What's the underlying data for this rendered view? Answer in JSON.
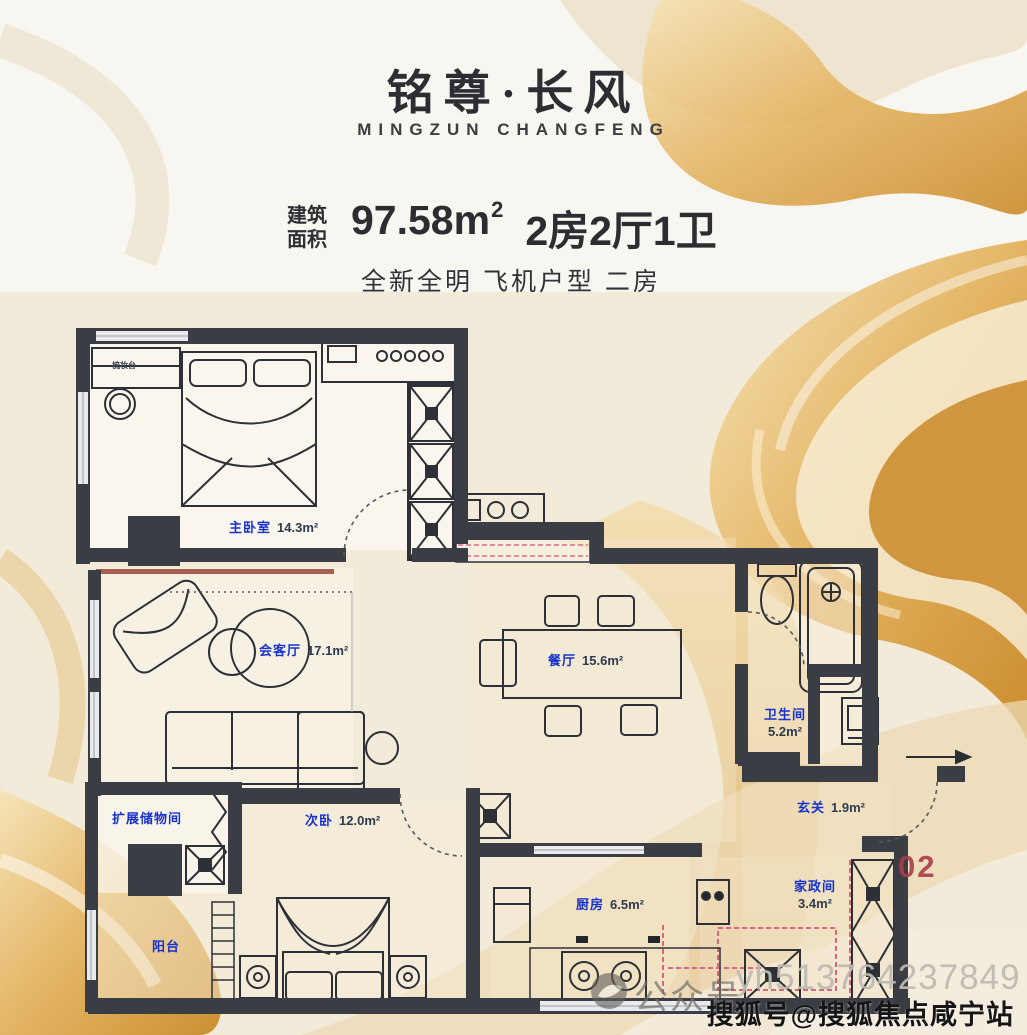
{
  "header": {
    "title": "铭尊·长风",
    "subtitle": "MINGZUN  CHANGFENG",
    "area_label_top": "建筑",
    "area_label_bottom": "面积",
    "area_value": "97.58m",
    "area_sup": "2",
    "layout_spec": "2房2厅1卫",
    "tagline": "全新全明 飞机户型 二房"
  },
  "floorplan": {
    "unit_number": "02",
    "desk_label": "梳妆台",
    "rooms": {
      "master": {
        "name": "主卧室",
        "area": "14.3m²"
      },
      "living": {
        "name": "会客厅",
        "area": "17.1m²"
      },
      "dining": {
        "name": "餐厅",
        "area": "15.6m²"
      },
      "bath": {
        "name": "卫生间",
        "area": "5.2m²"
      },
      "entry": {
        "name": "玄关",
        "area": "1.9m²"
      },
      "utility": {
        "name": "家政间",
        "area": "3.4m²"
      },
      "bedroom2": {
        "name": "次卧",
        "area": "12.0m²"
      },
      "storage": {
        "name": "扩展储物间",
        "area": ""
      },
      "kitchen": {
        "name": "厨房",
        "area": "6.5m²"
      },
      "balcony": {
        "name": "阳台",
        "area": ""
      }
    }
  },
  "watermark": {
    "wechat_label": "公众号",
    "wechat_id": "yh513764237849",
    "sohu": "搜狐号@搜狐焦点咸宁站"
  },
  "colors": {
    "label_blue": "#1733cc",
    "wall_dark": "#3a3e44",
    "gold_accent": "#d79a3f",
    "unit_red": "#a84252"
  }
}
